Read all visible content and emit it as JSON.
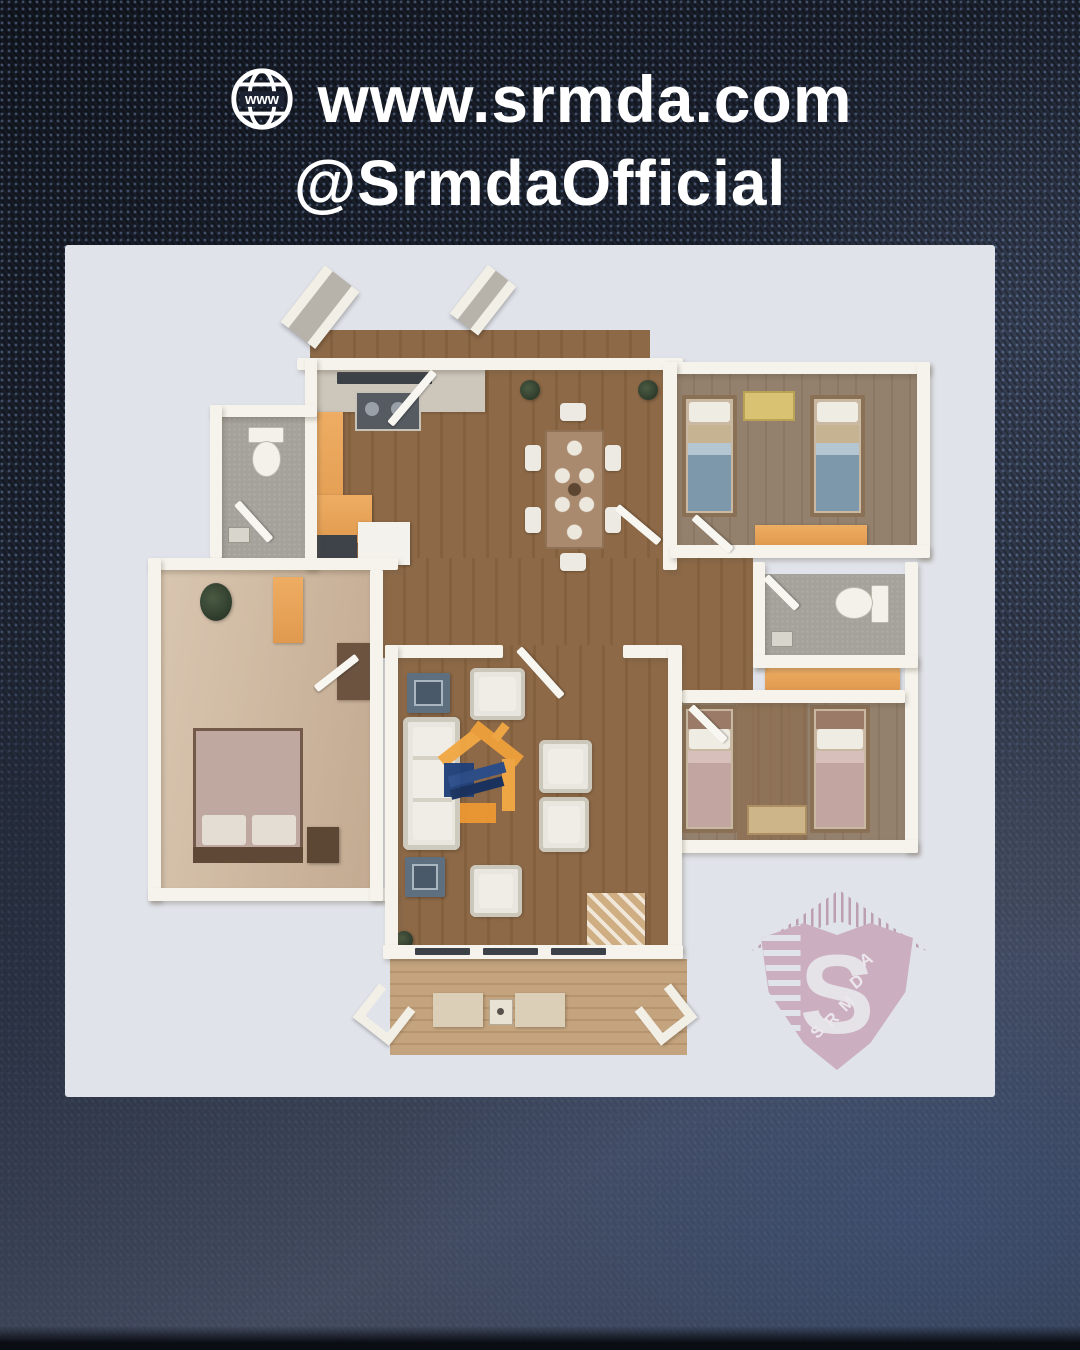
{
  "header": {
    "website": "www.srmda.com",
    "handle": "@SrmdaOfficial",
    "globe_label": "www"
  },
  "watermarks": {
    "shield": {
      "letter": "S",
      "arc_letters": [
        "S",
        "R",
        "M",
        "D",
        "A"
      ]
    }
  },
  "colors": {
    "background_navy": "#1d2330",
    "card": "#e0e3ea",
    "wall_white": "#f6f3ec",
    "wood_floor": "#8d6947",
    "porch_wood": "#c4a47e",
    "cabinet_orange": "#eead63",
    "bed_blue": "#7e98ab",
    "bed_mauve": "#c2a5a1",
    "logo_orange": "#f2a844",
    "logo_blue": "#20407a",
    "shield_pink": "#c6a0b3",
    "text_white": "#ffffff"
  }
}
